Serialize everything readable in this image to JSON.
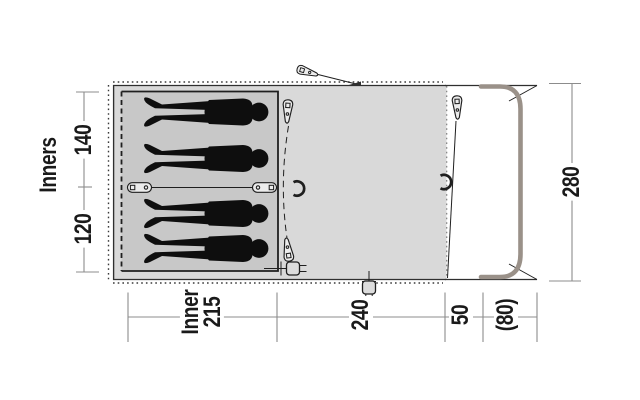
{
  "diagram": {
    "type": "tent-floorplan-top-view",
    "dims": {
      "inners_label": "Inners",
      "inner_width_top": "140",
      "inner_width_bottom": "120",
      "tent_depth": "280",
      "inner_label": "Inner",
      "inner_length": "215",
      "living_length": "240",
      "front_gap": "50",
      "canopy_depth": "(80)"
    },
    "figures": {
      "count": 4,
      "kind": "person-silhouette-lying"
    },
    "icons": [
      "tent-peg-icon",
      "guy-peg-icon",
      "toggle-peg-icon",
      "tieback-icon",
      "power-plug-icon",
      "front-pole"
    ],
    "colors": {
      "tent_body": "#d9d9d9",
      "inner_tent": "#c8c8c8",
      "outline": "#2f2f2f",
      "figure": "#0e0e0e",
      "pole": "#9a9189",
      "dimension_line": "#8c8c8c",
      "text": "#1a1a1a",
      "background": "#ffffff"
    }
  }
}
